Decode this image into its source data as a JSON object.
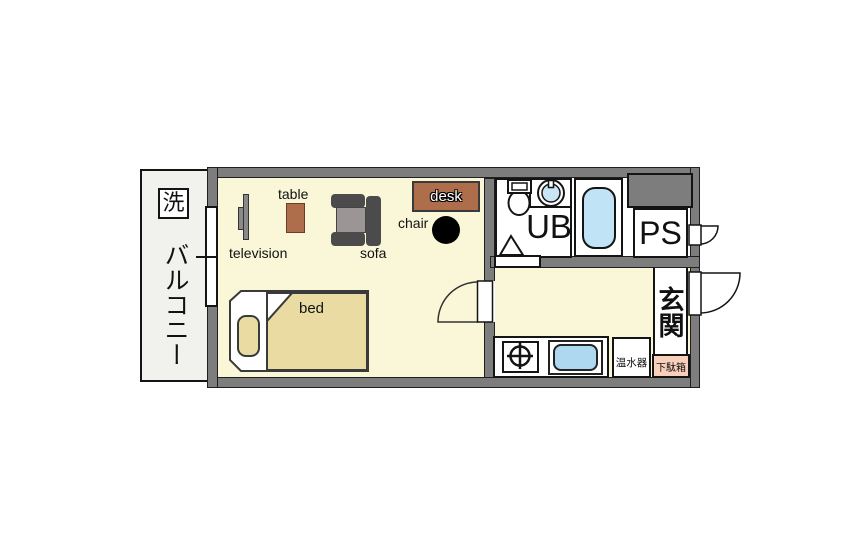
{
  "floorplan": {
    "balcony": {
      "label": "バルコニー",
      "washer": "洗"
    },
    "room": {
      "table": "table",
      "television": "television",
      "sofa": "sofa",
      "chair": "chair",
      "desk": "desk",
      "bed": "bed"
    },
    "sanitary": {
      "unit_bath": "UB"
    },
    "pipe_space": {
      "label": "PS"
    },
    "entrance": {
      "label": "玄関",
      "shoe_box": "下駄箱"
    },
    "kitchen": {
      "water_heater": "温水器"
    },
    "colors": {
      "wall": "#7d7d7d",
      "room_floor": "#faf7d8",
      "balcony_floor": "#f1f1ee",
      "furniture_wood": "#ae6e4b",
      "bedding": "#e9dba2",
      "bathtub": "#c0e3f6",
      "sink": "#aed8ef",
      "shoe_box_bg": "#f7cfbb",
      "sofa_dark": "#4b4b4b"
    }
  }
}
